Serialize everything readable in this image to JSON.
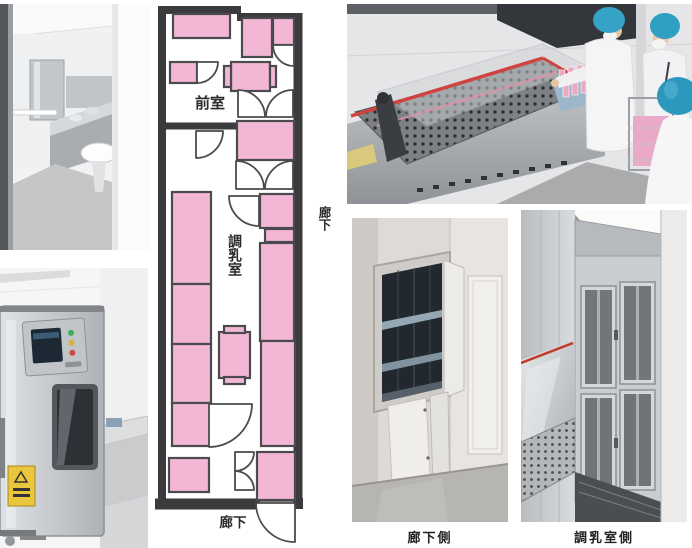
{
  "plan": {
    "labels": {
      "anteroom": "前室",
      "prep_room": "調乳室",
      "corridor_side": "廊下",
      "corridor_bottom": "廊下"
    }
  },
  "captions": {
    "corridor_side": "廊下側",
    "prep_room_side": "調乳室側"
  },
  "colors": {
    "plan_pink": "#F2B7D5",
    "plan_outline": "#4B4B4E",
    "plan_wall": "#3B3B3E",
    "caption_text": "#222222",
    "photo_red_trim": "#CF4440",
    "cap_blue": "#2F9FC4",
    "bottle_pink": "#EBA8C4",
    "warning_yellow": "#EAC63E",
    "steel_gray": "#C4C8CB"
  }
}
